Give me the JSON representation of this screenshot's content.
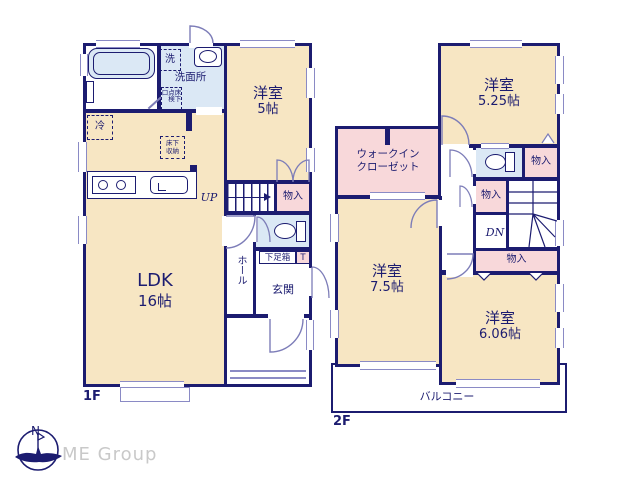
{
  "labels": {
    "floor1": "1F",
    "floor2": "2F",
    "ldk": "LDK",
    "ldk_size": "16帖",
    "western_room": "洋室",
    "size_5": "5帖",
    "size_5_25": "5.25帖",
    "size_7_5": "7.5帖",
    "size_6_06": "6.06帖",
    "bath": "浴室",
    "washroom": "洗面所",
    "laundry": "洗",
    "inspection_col_right": "床下",
    "inspection_col_left": "点検口",
    "fridge": "冷",
    "underfloor_line1": "床下",
    "underfloor_line2": "収納",
    "hall": "ホール",
    "entrance": "玄関",
    "shoe_box": "下足箱",
    "toilet_mark": "T",
    "closet": "物入",
    "wic_line1": "ウォークイン",
    "wic_line2": "クローゼット",
    "stairs_up": "UP",
    "stairs_down": "DN",
    "balcony": "バルコニー",
    "compass_north": "N",
    "company": "ME Group"
  },
  "colors": {
    "wall": "#1c1c70",
    "room_fill": "#f7e6c3",
    "closet_fill": "#f8d8da",
    "water_fill": "#dbe8f5",
    "door_line": "#7d7db8",
    "window_line": "#8a8ac5",
    "logo_gray": "#c9c9c9",
    "background": "#ffffff"
  }
}
